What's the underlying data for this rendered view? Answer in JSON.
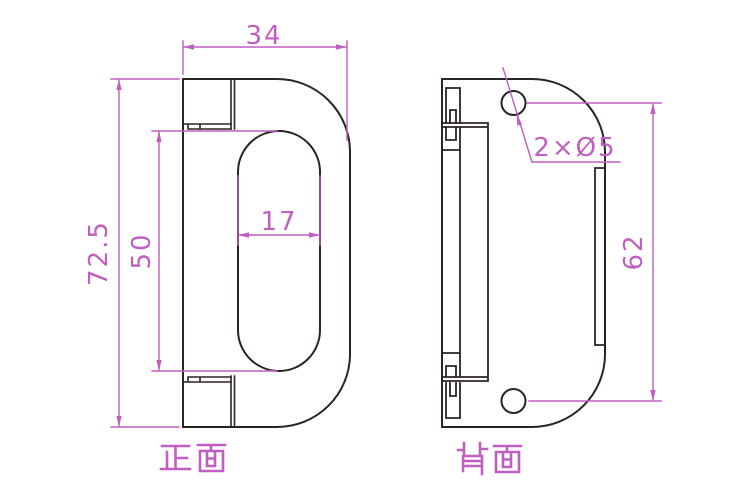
{
  "colors": {
    "background": "#ffffff",
    "line": "#2b2423",
    "dimension": "#c05fc0"
  },
  "views": {
    "front": {
      "label": "正面",
      "dims": {
        "overall_width": "34",
        "overall_height": "72.5",
        "slot_length": "50",
        "slot_width": "17"
      }
    },
    "back": {
      "label": "背面",
      "dims": {
        "holes": "2×Ø5",
        "hole_spacing": "62"
      }
    }
  }
}
